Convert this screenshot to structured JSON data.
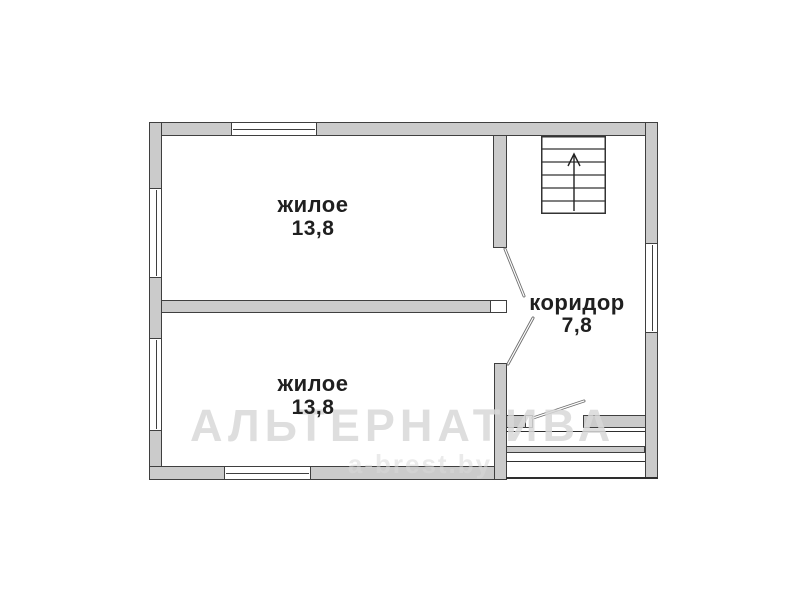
{
  "plan": {
    "rooms": [
      {
        "id": "room-top",
        "label": "жилое",
        "area": "13,8"
      },
      {
        "id": "room-bottom",
        "label": "жилое",
        "area": "13,8"
      },
      {
        "id": "corridor",
        "label": "коридор",
        "area": "7,8"
      }
    ],
    "features": {
      "staircase": "stairs with up-arrow, 6 treads, top-right",
      "windows": 5,
      "doors": 3
    }
  },
  "watermark": {
    "line1": "АЛЬТЕРНАТИВА",
    "line2": "a-brest.by"
  },
  "icons": {
    "stairs_arrow": "up-arrow"
  },
  "colors": {
    "bg": "#ffffff",
    "wall_fill": "#cbcbcb",
    "wall_outline": "#3f3f3f",
    "line": "#2e2e2e",
    "door_line": "#6f6f6f",
    "label": "#1f1f1f",
    "watermark": "#d9d9d9"
  }
}
